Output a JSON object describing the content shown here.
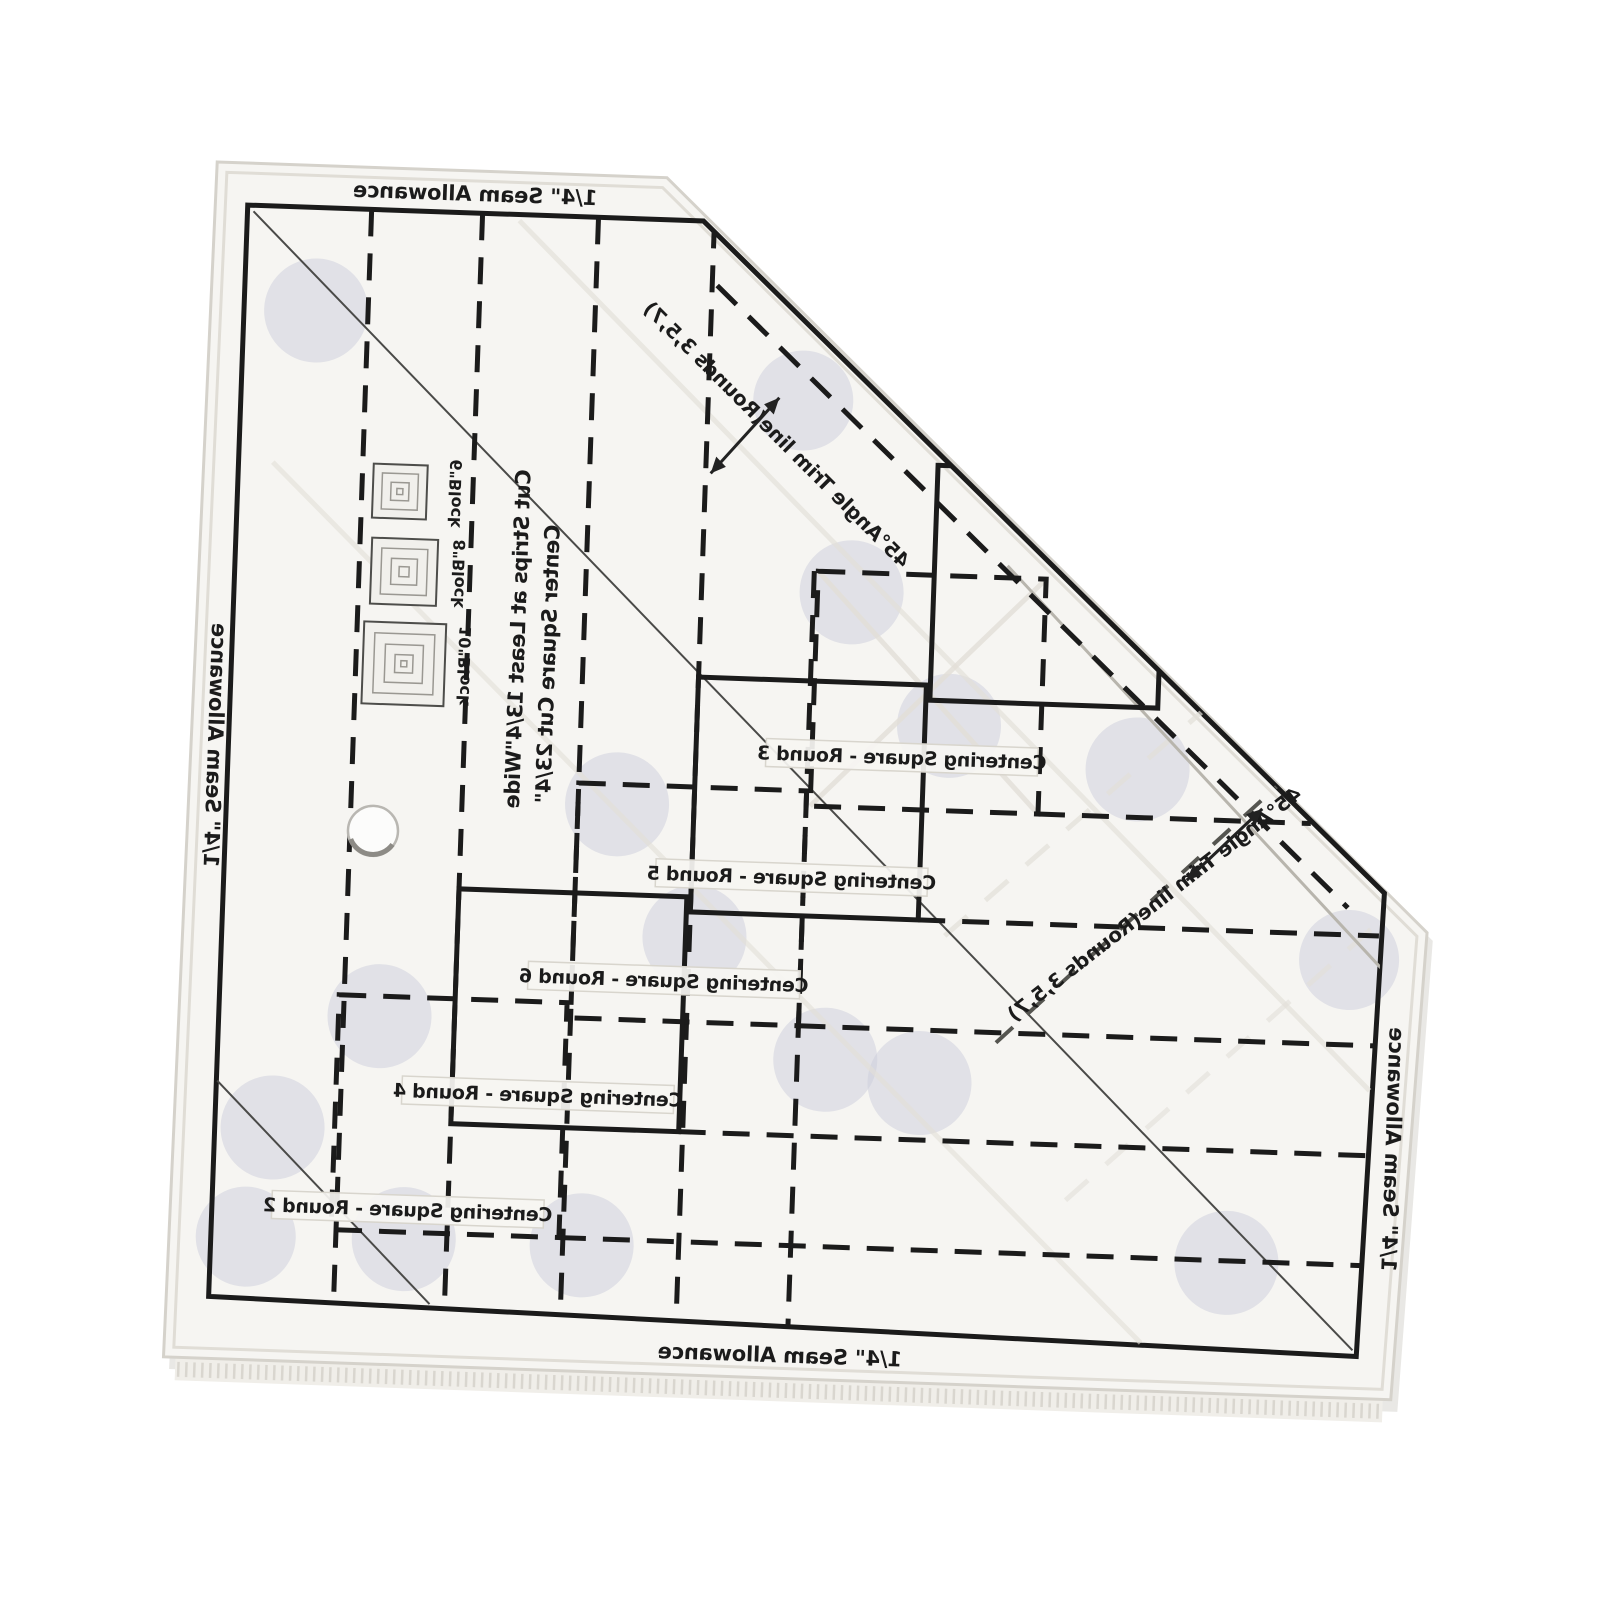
{
  "scene": {
    "description": "Back-side photo of a transparent acrylic log-cabin quilting trim ruler; pentagon shape with a 45-degree cut corner; all printing appears mirrored",
    "background_color": "#ffffff"
  },
  "ruler": {
    "edge_label": "1/4\" Seam Allowance",
    "trim_label": "45°Angle Trim line(Rounds 3,5,7)",
    "instruction_line1": "Cut Strips at Least 13/4\"Wide",
    "instruction_line2": "Center Square Cut 23/4\"",
    "blocks": [
      {
        "label": "6\"Block"
      },
      {
        "label": "8\"Block"
      },
      {
        "label": "10\"Block"
      }
    ],
    "rounds": [
      {
        "label": "Centering Square - Round 3"
      },
      {
        "label": "Centering Square - Round 5"
      },
      {
        "label": "Centering Square - Round 6"
      },
      {
        "label": "Centering Square - Round 4"
      },
      {
        "label": "Centering Square - Round 2"
      }
    ],
    "colors": {
      "print": "#1b1b1b",
      "body": "#f6f5f2",
      "grip_dot": "#cbcedb",
      "acrylic_edge": "#d5d2cb"
    }
  }
}
